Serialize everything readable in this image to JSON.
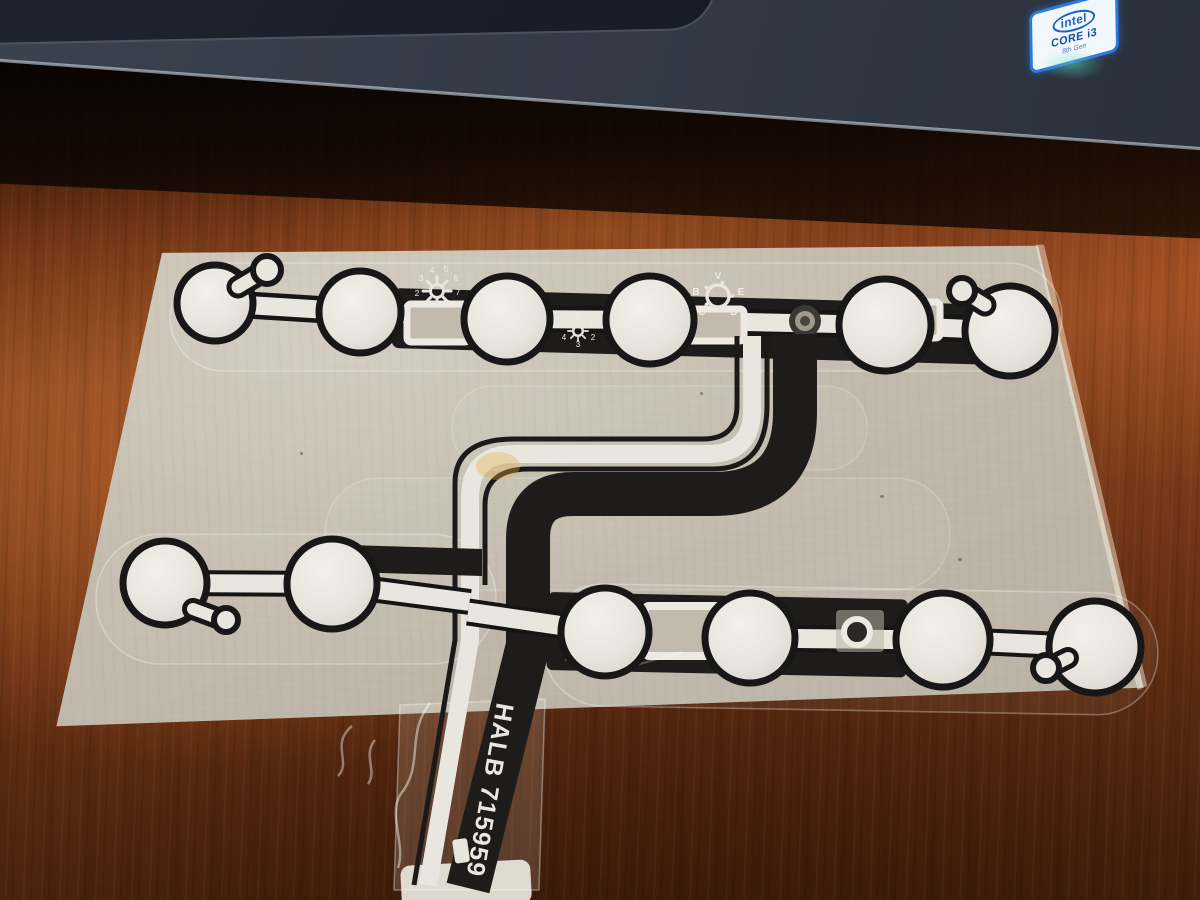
{
  "laptop": {
    "sticker": {
      "brand": "intel",
      "model": "CORE i3",
      "generation": "8th Gen"
    }
  },
  "membrane": {
    "part_number": "HALB 715959",
    "brightness_dial": {
      "icon": "sun-dial-icon",
      "numbers": [
        "2",
        "3",
        "4",
        "5",
        "6",
        "7",
        "8"
      ]
    },
    "small_dial": {
      "icon": "sun-dial-icon",
      "numbers": [
        "0",
        "1",
        "2",
        "3",
        "4",
        "5"
      ]
    },
    "selector_dial": {
      "icon": "rotary-selector-icon",
      "letters": [
        "V",
        "B",
        "E",
        "C",
        "D"
      ]
    }
  },
  "colors": {
    "trace_black": "#1d1c1a",
    "trace_silver": "#e8e6df",
    "cardboard": "#c3bcae",
    "desk_wood": "#8a4520",
    "laptop_body": "#313844",
    "sticker_blue": "#2a79e0"
  }
}
